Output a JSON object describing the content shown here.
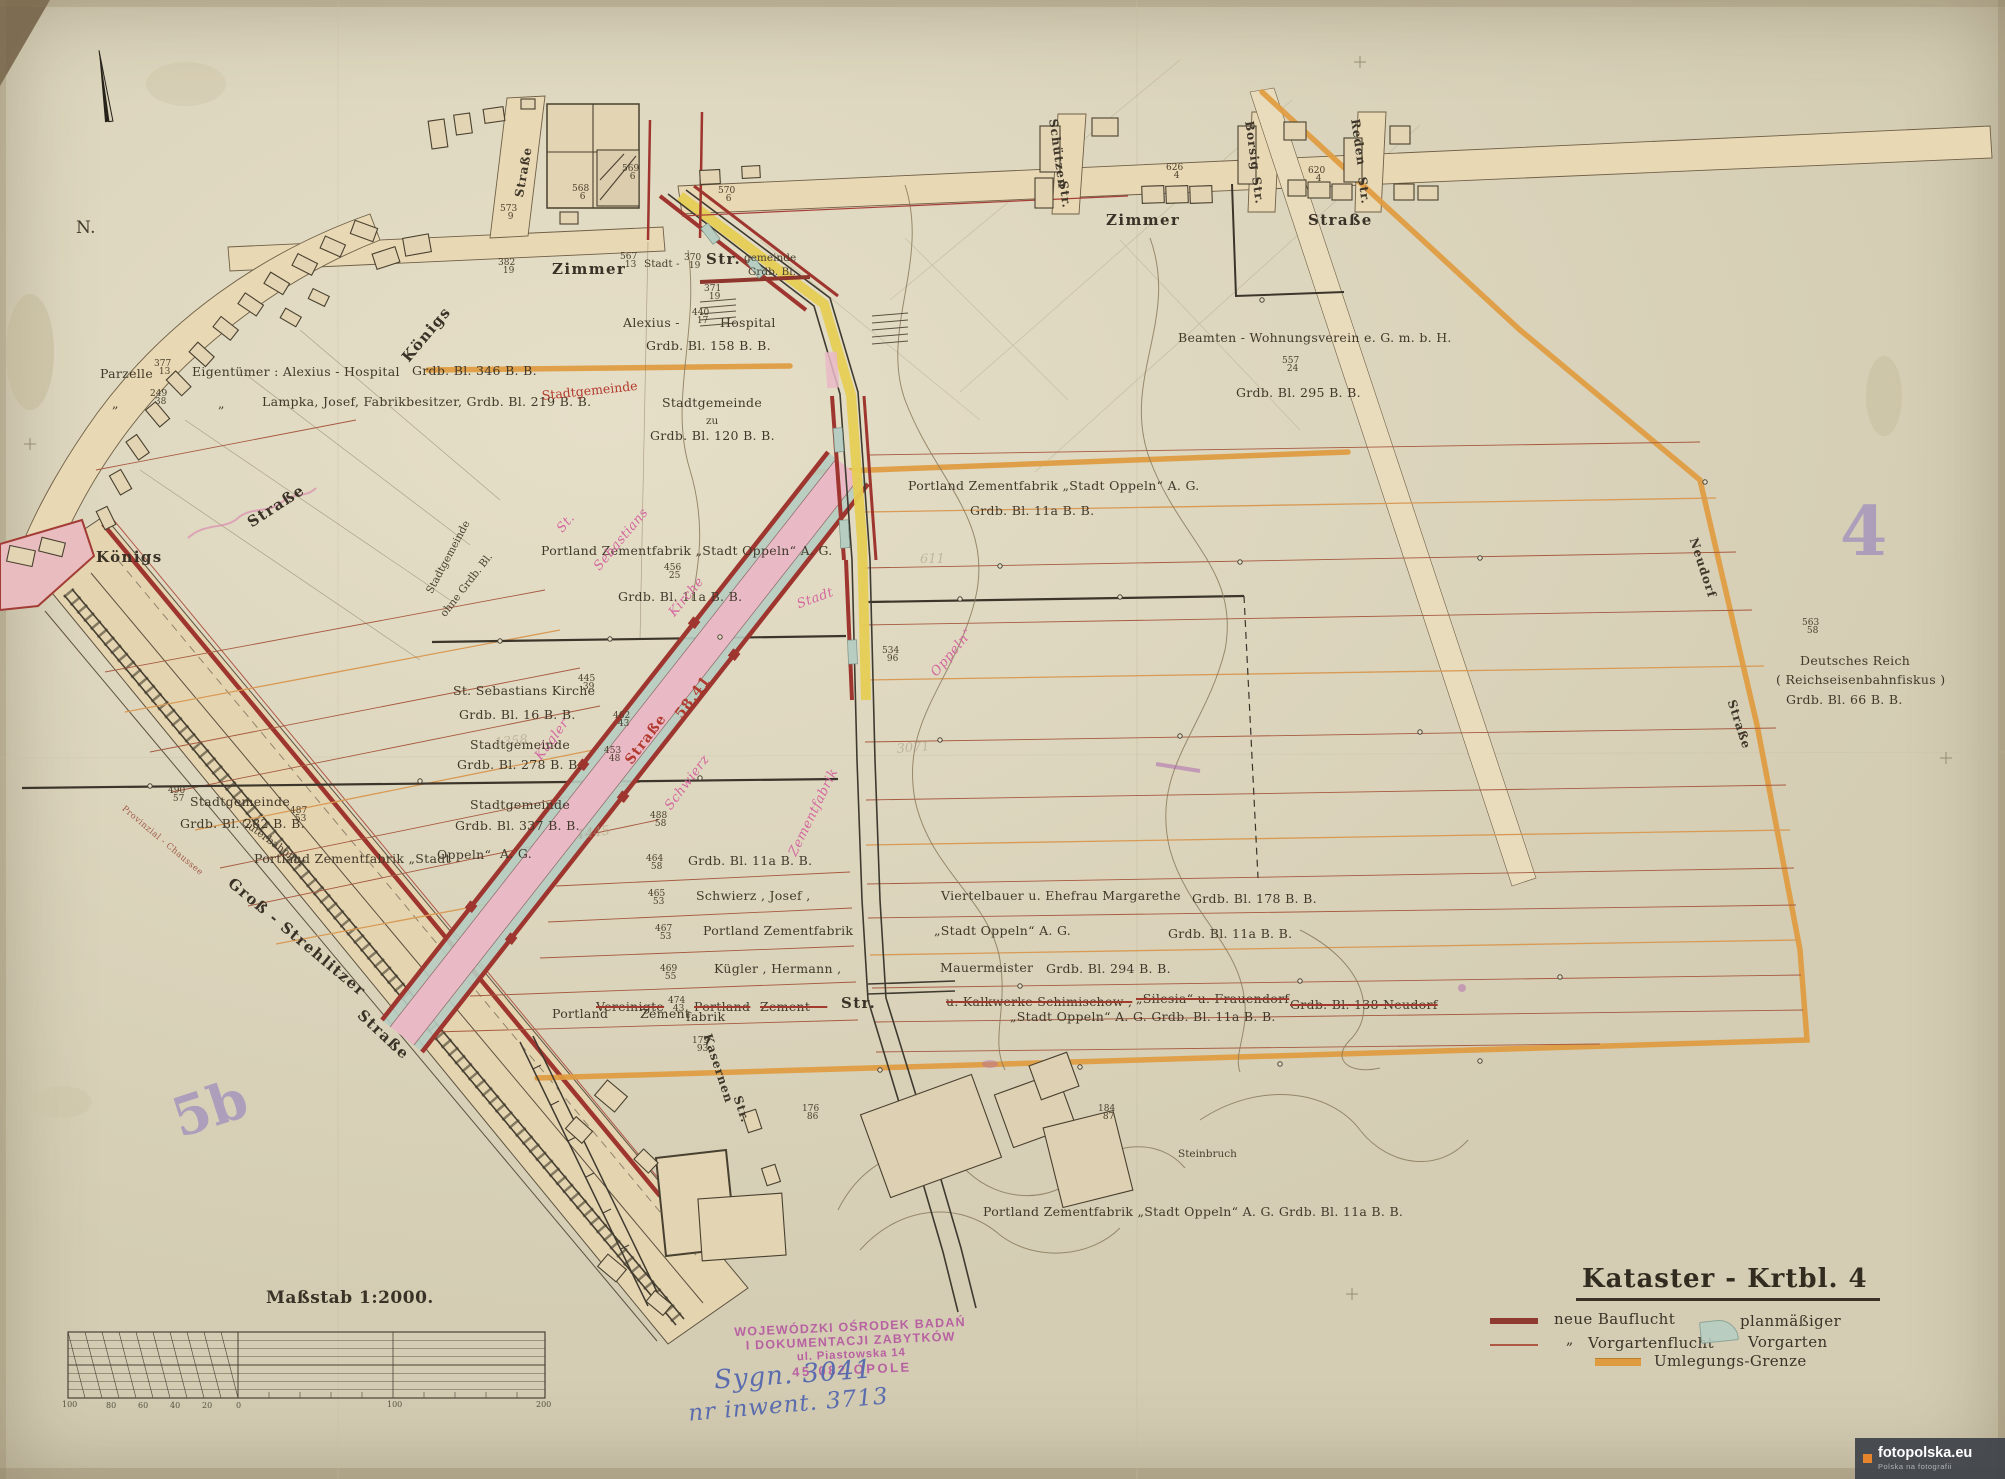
{
  "colors": {
    "paper": "#ded7bf",
    "ink": "#42382a",
    "bauflucht_red": "#9e352e",
    "vorgarten_green": "#b7cdc2",
    "street_pink": "#e9bac6",
    "umlegung_orange": "#df9b3f",
    "highlight_yellow": "#e6cd55",
    "pink_script": "#d4679f",
    "sheet_purple": "#a392bd",
    "stamp_purple": "#b44fa0",
    "handwriting_blue": "#5a6cae"
  },
  "sheet_numbers": {
    "right": "4",
    "left": "5b"
  },
  "title_block": {
    "title": "Kataster - Krtbl. 4",
    "legend": [
      {
        "swatch": "neue-bauflucht-line",
        "label": "neue  Bauflucht"
      },
      {
        "swatch": "vorgartenflucht-line",
        "mark": "„",
        "label": "Vorgartenflucht"
      },
      {
        "swatch": "planmaessiger-vorgarten-area",
        "label_top": "planmäßiger",
        "label_bottom": "Vorgarten"
      },
      {
        "swatch": "umlegungs-grenze-line",
        "label": "Umlegungs-Grenze"
      }
    ]
  },
  "scale_bar": {
    "title": "Maßstab 1:2000."
  },
  "stamp": {
    "line1": "WOJEWÓDZKI OŚRODEK BADAŃ",
    "line2": "I DOKUMENTACJI ZABYTKÓW",
    "line3": "ul. Piastowska 14",
    "line4": "45-082 OPOLE",
    "sygn": "Sygn. 3041",
    "inwent": "nr inwent. 3713"
  },
  "watermark": {
    "site": "fotopolska.eu",
    "tagline": "Polska na fotografii"
  },
  "labels": [
    {
      "t": "N.",
      "x": 76,
      "y": 218,
      "c": "own",
      "fs": 17,
      "n": "north-label"
    },
    {
      "t": "Straße",
      "x": 512,
      "y": 196,
      "r": -80,
      "c": "stm",
      "n": "street-label"
    },
    {
      "t": "Zimmer",
      "x": 552,
      "y": 260,
      "c": "st",
      "n": "street-label-zimmer-west"
    },
    {
      "t": "Stadt -",
      "x": 644,
      "y": 258,
      "c": "sm"
    },
    {
      "t": "Str.",
      "x": 706,
      "y": 250,
      "c": "st"
    },
    {
      "t": "gemeinde",
      "x": 744,
      "y": 252,
      "c": "sm"
    },
    {
      "t": "Grdb. Bl.",
      "x": 748,
      "y": 266,
      "c": "sm"
    },
    {
      "t": "567|13",
      "x": 620,
      "y": 254,
      "c": "fr"
    },
    {
      "t": "370|19",
      "x": 684,
      "y": 255,
      "c": "fr"
    },
    {
      "t": "371|19",
      "x": 704,
      "y": 286,
      "c": "fr"
    },
    {
      "t": "382|19",
      "x": 498,
      "y": 260,
      "c": "fr"
    },
    {
      "t": "573|9",
      "x": 500,
      "y": 206,
      "c": "fr"
    },
    {
      "t": "568|6",
      "x": 572,
      "y": 186,
      "c": "fr"
    },
    {
      "t": "569|6",
      "x": 622,
      "y": 166,
      "c": "fr"
    },
    {
      "t": "570|6",
      "x": 718,
      "y": 188,
      "c": "fr"
    },
    {
      "t": "Zimmer",
      "x": 1106,
      "y": 211,
      "c": "st",
      "n": "street-label-zimmer-east"
    },
    {
      "t": "Straße",
      "x": 1308,
      "y": 211,
      "c": "st"
    },
    {
      "t": "Schützen",
      "x": 1060,
      "y": 118,
      "r": 82,
      "c": "stm",
      "n": "street-label-schuetzen"
    },
    {
      "t": "Str.",
      "x": 1070,
      "y": 180,
      "r": 82,
      "c": "stm"
    },
    {
      "t": "Borsig",
      "x": 1256,
      "y": 120,
      "r": 82,
      "c": "stm",
      "n": "street-label-borsig"
    },
    {
      "t": "Str.",
      "x": 1263,
      "y": 176,
      "r": 82,
      "c": "stm"
    },
    {
      "t": "Reden",
      "x": 1362,
      "y": 118,
      "r": 82,
      "c": "stm",
      "n": "street-label-reden"
    },
    {
      "t": "Str.",
      "x": 1369,
      "y": 176,
      "r": 82,
      "c": "stm"
    },
    {
      "t": "626|4",
      "x": 1166,
      "y": 165,
      "c": "fr"
    },
    {
      "t": "620|4",
      "x": 1308,
      "y": 168,
      "c": "fr"
    },
    {
      "t": "Parzelle",
      "x": 100,
      "y": 366,
      "c": "own"
    },
    {
      "t": "377|13",
      "x": 154,
      "y": 361,
      "c": "fr"
    },
    {
      "t": "Eigentümer :  Alexius - Hospital",
      "x": 192,
      "y": 364,
      "c": "own"
    },
    {
      "t": "Grdb. Bl. 346  B. B.",
      "x": 412,
      "y": 363,
      "c": "own"
    },
    {
      "t": "„",
      "x": 112,
      "y": 396,
      "c": "own"
    },
    {
      "t": "249|38",
      "x": 150,
      "y": 391,
      "c": "fr"
    },
    {
      "t": "„",
      "x": 218,
      "y": 396,
      "c": "own"
    },
    {
      "t": "Lampka, Josef, Fabrikbesitzer,  Grdb. Bl. 219  B. B.",
      "x": 262,
      "y": 394,
      "c": "own"
    },
    {
      "t": "Königs",
      "x": 398,
      "y": 354,
      "r": -50,
      "c": "st",
      "n": "street-label-koenigs"
    },
    {
      "t": "Stadtgemeinde",
      "x": 424,
      "y": 590,
      "r": -62,
      "c": "sm"
    },
    {
      "t": "ohne Grdb. Bl.",
      "x": 438,
      "y": 612,
      "r": -52,
      "c": "sm"
    },
    {
      "t": "Königs",
      "x": 96,
      "y": 548,
      "c": "st"
    },
    {
      "t": "Straße",
      "x": 244,
      "y": 516,
      "r": -33,
      "c": "st"
    },
    {
      "t": "Alexius -",
      "x": 623,
      "y": 315,
      "c": "own"
    },
    {
      "t": "440|17",
      "x": 692,
      "y": 310,
      "c": "fr"
    },
    {
      "t": "Hospital",
      "x": 720,
      "y": 315,
      "c": "own"
    },
    {
      "t": "Grdb. Bl. 158  B. B.",
      "x": 646,
      "y": 338,
      "c": "own"
    },
    {
      "t": "Stadtgemeinde",
      "x": 662,
      "y": 395,
      "c": "own"
    },
    {
      "t": "zu",
      "x": 706,
      "y": 415,
      "c": "sm"
    },
    {
      "t": "Grdb. Bl. 120  B. B.",
      "x": 650,
      "y": 428,
      "c": "own"
    },
    {
      "t": "Stadtgemeinde",
      "x": 541,
      "y": 388,
      "r": -6,
      "c": "red"
    },
    {
      "t": "Portland Zementfabrik „Stadt Oppeln“ A. G.",
      "x": 541,
      "y": 543,
      "c": "own"
    },
    {
      "t": "456|25",
      "x": 664,
      "y": 565,
      "c": "fr"
    },
    {
      "t": "Grdb. Bl. 11a  B. B.",
      "x": 618,
      "y": 589,
      "c": "own"
    },
    {
      "t": "St.",
      "x": 554,
      "y": 526,
      "r": -50,
      "c": "pink"
    },
    {
      "t": "Sebastians",
      "x": 591,
      "y": 564,
      "r": -50,
      "c": "pink"
    },
    {
      "t": "Kirche",
      "x": 666,
      "y": 610,
      "r": -50,
      "c": "pink"
    },
    {
      "t": "Straße",
      "x": 622,
      "y": 758,
      "r": -53,
      "c": "redb"
    },
    {
      "t": "58,41",
      "x": 672,
      "y": 712,
      "r": -53,
      "c": "redb"
    },
    {
      "t": "Kügler",
      "x": 532,
      "y": 754,
      "r": -53,
      "c": "pink"
    },
    {
      "t": "Schwierz",
      "x": 662,
      "y": 804,
      "r": -53,
      "c": "pink"
    },
    {
      "t": "Zementfabrik",
      "x": 786,
      "y": 852,
      "r": -64,
      "c": "pink"
    },
    {
      "t": "Stadt",
      "x": 795,
      "y": 598,
      "r": -20,
      "c": "pink"
    },
    {
      "t": "Oppeln“",
      "x": 928,
      "y": 670,
      "r": -50,
      "c": "pink"
    },
    {
      "t": "St. Sebastians  Kirche",
      "x": 453,
      "y": 683,
      "c": "own"
    },
    {
      "t": "445|39",
      "x": 578,
      "y": 676,
      "c": "fr"
    },
    {
      "t": "Grdb. Bl. 16  B. B.",
      "x": 459,
      "y": 707,
      "c": "own"
    },
    {
      "t": "462|43",
      "x": 613,
      "y": 713,
      "c": "fr"
    },
    {
      "t": "Stadtgemeinde",
      "x": 470,
      "y": 737,
      "c": "own"
    },
    {
      "t": "Grdb. Bl. 278  B. B.",
      "x": 457,
      "y": 757,
      "c": "own"
    },
    {
      "t": "453|48",
      "x": 604,
      "y": 748,
      "c": "fr"
    },
    {
      "t": "Stadtgemeinde",
      "x": 470,
      "y": 797,
      "c": "own"
    },
    {
      "t": "Grdb. Bl. 337  B. B.",
      "x": 455,
      "y": 818,
      "c": "own"
    },
    {
      "t": "488|58",
      "x": 650,
      "y": 813,
      "c": "fr"
    },
    {
      "t": "Stadtgemeinde",
      "x": 190,
      "y": 794,
      "c": "own"
    },
    {
      "t": "490|57",
      "x": 168,
      "y": 788,
      "c": "fr"
    },
    {
      "t": "Grdb. Bl. 282  B. B.",
      "x": 180,
      "y": 816,
      "c": "own"
    },
    {
      "t": "487|53",
      "x": 290,
      "y": 808,
      "c": "fr"
    },
    {
      "t": "Portland Zementfabrik „Stadt",
      "x": 254,
      "y": 851,
      "c": "own"
    },
    {
      "t": "Oppeln“",
      "x": 437,
      "y": 847,
      "c": "own"
    },
    {
      "t": "A. G.",
      "x": 500,
      "y": 846,
      "c": "own"
    },
    {
      "t": "Grdb. Bl.  11a  B. B.",
      "x": 688,
      "y": 853,
      "c": "own"
    },
    {
      "t": "464|58",
      "x": 646,
      "y": 856,
      "c": "fr"
    },
    {
      "t": "Schwierz , Josef ,",
      "x": 696,
      "y": 888,
      "c": "own"
    },
    {
      "t": "465|53",
      "x": 648,
      "y": 891,
      "c": "fr"
    },
    {
      "t": "Portland  Zementfabrik",
      "x": 703,
      "y": 923,
      "c": "own"
    },
    {
      "t": "467|53",
      "x": 655,
      "y": 926,
      "c": "fr"
    },
    {
      "t": "Kügler , Hermann ,",
      "x": 714,
      "y": 961,
      "c": "own"
    },
    {
      "t": "469|55",
      "x": 660,
      "y": 966,
      "c": "fr"
    },
    {
      "t": "Portland",
      "x": 552,
      "y": 1006,
      "c": "own"
    },
    {
      "t": "Vereinigte",
      "x": 596,
      "y": 999,
      "c": "own strike"
    },
    {
      "t": "Zement",
      "x": 640,
      "y": 1006,
      "c": "own"
    },
    {
      "t": "474|43",
      "x": 668,
      "y": 998,
      "c": "fr"
    },
    {
      "t": "Portland",
      "x": 694,
      "y": 999,
      "c": "own strike"
    },
    {
      "t": "fabrik",
      "x": 686,
      "y": 1009,
      "c": "own"
    },
    {
      "t": "Zement —",
      "x": 760,
      "y": 999,
      "c": "own strike"
    },
    {
      "t": "Str.",
      "x": 841,
      "y": 994,
      "c": "st"
    },
    {
      "t": "179|93",
      "x": 692,
      "y": 1038,
      "c": "fr"
    },
    {
      "t": "Kasernen",
      "x": 714,
      "y": 1032,
      "r": 72,
      "c": "stm",
      "n": "street-label-kasernen"
    },
    {
      "t": "Str.",
      "x": 744,
      "y": 1094,
      "r": 72,
      "c": "stm"
    },
    {
      "t": "Portland  Zementfabrik  „Stadt  Oppeln“  A. G.",
      "x": 908,
      "y": 478,
      "c": "own"
    },
    {
      "t": "Grdb. Bl. 11a  B. B.",
      "x": 970,
      "y": 503,
      "c": "own"
    },
    {
      "t": "Viertelbauer  u.  Ehefrau  Margarethe",
      "x": 941,
      "y": 888,
      "c": "own"
    },
    {
      "t": "Grdb. Bl. 178  B. B.",
      "x": 1192,
      "y": 891,
      "c": "own"
    },
    {
      "t": "„Stadt  Oppeln“   A. G.",
      "x": 934,
      "y": 923,
      "c": "own"
    },
    {
      "t": "Grdb.  Bl.   11a   B. B.",
      "x": 1168,
      "y": 926,
      "c": "own"
    },
    {
      "t": "Mauermeister",
      "x": 940,
      "y": 960,
      "c": "own"
    },
    {
      "t": "Grdb. Bl.     294   B. B.",
      "x": 1046,
      "y": 961,
      "c": "own"
    },
    {
      "t": "u.  Kalkwerke   Schimischow ,",
      "x": 946,
      "y": 994,
      "c": "own strike"
    },
    {
      "t": "„Silesia“  u.  Frauendorf",
      "x": 1136,
      "y": 991,
      "c": "own strike"
    },
    {
      "t": "Grdb.  Bl.  138  Neudorf",
      "x": 1290,
      "y": 997,
      "c": "own strike"
    },
    {
      "t": "„Stadt Oppeln“    A. G.     Grdb. Bl. 11a   B. B.",
      "x": 1010,
      "y": 1009,
      "c": "own"
    },
    {
      "t": "Beamten - Wohnungsverein   e. G. m. b. H.",
      "x": 1178,
      "y": 330,
      "c": "own"
    },
    {
      "t": "557|24",
      "x": 1282,
      "y": 358,
      "c": "fr"
    },
    {
      "t": "Grdb. Bl. 295   B. B.",
      "x": 1236,
      "y": 385,
      "c": "own"
    },
    {
      "t": "Deutsches  Reich",
      "x": 1800,
      "y": 653,
      "c": "own"
    },
    {
      "t": "( Reichseisenbahnfiskus )",
      "x": 1776,
      "y": 672,
      "c": "own"
    },
    {
      "t": "Grdb. Bl.  66   B. B.",
      "x": 1786,
      "y": 692,
      "c": "own"
    },
    {
      "t": "563|58",
      "x": 1802,
      "y": 620,
      "c": "fr"
    },
    {
      "t": "Neudorf",
      "x": 1700,
      "y": 536,
      "r": 72,
      "c": "stm",
      "n": "street-label-neudorf"
    },
    {
      "t": "Straße",
      "x": 1738,
      "y": 698,
      "r": 72,
      "c": "stm"
    },
    {
      "t": "534|96",
      "x": 882,
      "y": 648,
      "c": "fr"
    },
    {
      "t": "Steinbruch",
      "x": 1178,
      "y": 1148,
      "c": "sm",
      "n": "quarry-label"
    },
    {
      "t": "176|86",
      "x": 802,
      "y": 1106,
      "c": "fr"
    },
    {
      "t": "184|87",
      "x": 1098,
      "y": 1106,
      "c": "fr"
    },
    {
      "t": "Portland  Zementfabrik  „Stadt  Oppeln“   A. G.   Grdb. Bl. 11a  B. B.",
      "x": 983,
      "y": 1204,
      "c": "own"
    },
    {
      "t": "Groß - Strehlitzer",
      "x": 236,
      "y": 874,
      "r": 40,
      "c": "st",
      "n": "street-label-gross-strehlitzer"
    },
    {
      "t": "Straße",
      "x": 366,
      "y": 1006,
      "r": 43,
      "c": "st"
    },
    {
      "t": "Güterbahnhof",
      "x": 246,
      "y": 816,
      "r": 36,
      "c": "sm",
      "n": "freight-yard-label"
    },
    {
      "t": "Provinzial - Chaussee",
      "x": 126,
      "y": 804,
      "r": 40,
      "c": "tn"
    },
    {
      "t": "1358",
      "x": 494,
      "y": 736,
      "r": -6,
      "c": "ghost"
    },
    {
      "t": "1445",
      "x": 576,
      "y": 828,
      "r": -8,
      "c": "ghost"
    },
    {
      "t": "611",
      "x": 920,
      "y": 552,
      "c": "ghost"
    },
    {
      "t": "3071",
      "x": 896,
      "y": 742,
      "r": -5,
      "c": "ghost"
    },
    {
      "t": "100",
      "x": 62,
      "y": 1400,
      "c": "tick"
    },
    {
      "t": "80",
      "x": 106,
      "y": 1401,
      "c": "tick"
    },
    {
      "t": "60",
      "x": 138,
      "y": 1401,
      "c": "tick"
    },
    {
      "t": "40",
      "x": 170,
      "y": 1401,
      "c": "tick"
    },
    {
      "t": "20",
      "x": 202,
      "y": 1401,
      "c": "tick"
    },
    {
      "t": "0",
      "x": 236,
      "y": 1401,
      "c": "tick"
    },
    {
      "t": "100",
      "x": 387,
      "y": 1400,
      "c": "tick"
    },
    {
      "t": "200",
      "x": 536,
      "y": 1400,
      "c": "tick"
    }
  ]
}
